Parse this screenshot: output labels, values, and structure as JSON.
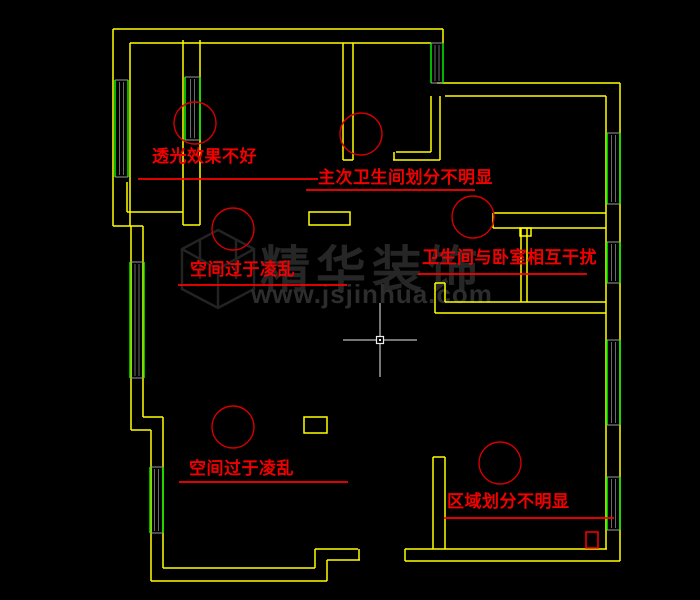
{
  "canvas": {
    "width": 700,
    "height": 600,
    "background": "#000000"
  },
  "colors": {
    "wall": "#ffff00",
    "window_frame": "#00f000",
    "window_glass": "#6a6a6a",
    "window_cap": "#9a9a9a",
    "annotation_line": "#ff0000",
    "annotation_circle": "#d40000",
    "annotation_text": "#f20000",
    "watermark": "#262626",
    "crosshair": "#ececec"
  },
  "watermark": {
    "brand": "精华装饰",
    "url": "www.jsjinhua.com"
  },
  "annotations": [
    {
      "label": "透光效果不好",
      "label_pos": [
        152,
        147
      ],
      "underline": [
        138,
        179,
        318
      ],
      "circle": [
        195,
        123,
        21
      ]
    },
    {
      "label": "主次卫生间划分不明显",
      "label_pos": [
        318,
        168
      ],
      "underline": [
        306,
        190,
        475
      ],
      "circle": [
        361,
        134,
        21
      ]
    },
    {
      "label": "空间过于凌乱",
      "label_pos": [
        190,
        260
      ],
      "underline": [
        178,
        285,
        347
      ],
      "circle": [
        233,
        229,
        21
      ]
    },
    {
      "label": "卫生间与卧室相互干扰",
      "label_pos": [
        422,
        248
      ],
      "underline": [
        418,
        274,
        587
      ],
      "circle": [
        473,
        217,
        21
      ]
    },
    {
      "label": "空间过于凌乱",
      "label_pos": [
        189,
        459
      ],
      "underline": [
        179,
        482,
        348
      ],
      "circle": [
        233,
        427,
        21
      ]
    },
    {
      "label": "区域划分不明显",
      "label_pos": [
        447,
        492
      ],
      "underline": [
        444,
        518,
        614
      ],
      "circle": [
        500,
        463,
        21
      ]
    }
  ],
  "plan": {
    "walls": [
      [
        113,
        29,
        443,
        29
      ],
      [
        130,
        43,
        431,
        43
      ],
      [
        443,
        29,
        443,
        43
      ],
      [
        113,
        29,
        113,
        226
      ],
      [
        130,
        43,
        130,
        226
      ],
      [
        113,
        226,
        143,
        226
      ],
      [
        131,
        226,
        131,
        430
      ],
      [
        143,
        226,
        143,
        417
      ],
      [
        143,
        417,
        163,
        417
      ],
      [
        131,
        430,
        151,
        430
      ],
      [
        151,
        430,
        151,
        581
      ],
      [
        163,
        417,
        163,
        568
      ],
      [
        163,
        568,
        315,
        568
      ],
      [
        151,
        581,
        327,
        581
      ],
      [
        315,
        549,
        315,
        568
      ],
      [
        327,
        560,
        327,
        581
      ],
      [
        315,
        549,
        358,
        549
      ],
      [
        327,
        560,
        360,
        560
      ],
      [
        359,
        549,
        359,
        560
      ],
      [
        405,
        549,
        405,
        561
      ],
      [
        405,
        549,
        607,
        549
      ],
      [
        405,
        561,
        620,
        561
      ],
      [
        620,
        83,
        620,
        561
      ],
      [
        606,
        96,
        606,
        549
      ],
      [
        437,
        83,
        620,
        83
      ],
      [
        445,
        96,
        606,
        96
      ],
      [
        183,
        40,
        183,
        225
      ],
      [
        200,
        40,
        200,
        225
      ],
      [
        183,
        225,
        200,
        225
      ],
      [
        127,
        182,
        127,
        212
      ],
      [
        127,
        212,
        183,
        212
      ],
      [
        343,
        43,
        343,
        160
      ],
      [
        353,
        43,
        353,
        160
      ],
      [
        343,
        160,
        353,
        160
      ],
      [
        431,
        96,
        431,
        152
      ],
      [
        440,
        96,
        440,
        160
      ],
      [
        396,
        152,
        431,
        152
      ],
      [
        393,
        160,
        440,
        160
      ],
      [
        394,
        152,
        394,
        160
      ],
      [
        493,
        213,
        606,
        213
      ],
      [
        493,
        228,
        606,
        228
      ],
      [
        493,
        213,
        493,
        228
      ],
      [
        521,
        228,
        521,
        302
      ],
      [
        527,
        228,
        527,
        302
      ],
      [
        445,
        302,
        606,
        302
      ],
      [
        435,
        313,
        606,
        313
      ],
      [
        435,
        283,
        435,
        313
      ],
      [
        445,
        283,
        445,
        302
      ],
      [
        435,
        283,
        445,
        283
      ],
      [
        433,
        457,
        433,
        549
      ],
      [
        445,
        457,
        445,
        549
      ],
      [
        433,
        457,
        445,
        457
      ]
    ],
    "yellow_rects": [
      [
        309,
        212,
        41,
        13
      ],
      [
        304,
        417,
        23,
        16
      ],
      [
        520,
        228,
        11,
        8
      ]
    ],
    "windows": [
      [
        115,
        80,
        13,
        97
      ],
      [
        130,
        262,
        14,
        116
      ],
      [
        150,
        467,
        13,
        66
      ],
      [
        185,
        77,
        15,
        63
      ],
      [
        431,
        43,
        12,
        40
      ],
      [
        607,
        133,
        13,
        71
      ],
      [
        607,
        242,
        13,
        41
      ],
      [
        607,
        340,
        13,
        85
      ],
      [
        607,
        477,
        13,
        53
      ]
    ],
    "red_rect": [
      586,
      532,
      12,
      16
    ],
    "crosshair": {
      "x": 380,
      "y": 340,
      "arm": 37,
      "box": 7
    }
  }
}
